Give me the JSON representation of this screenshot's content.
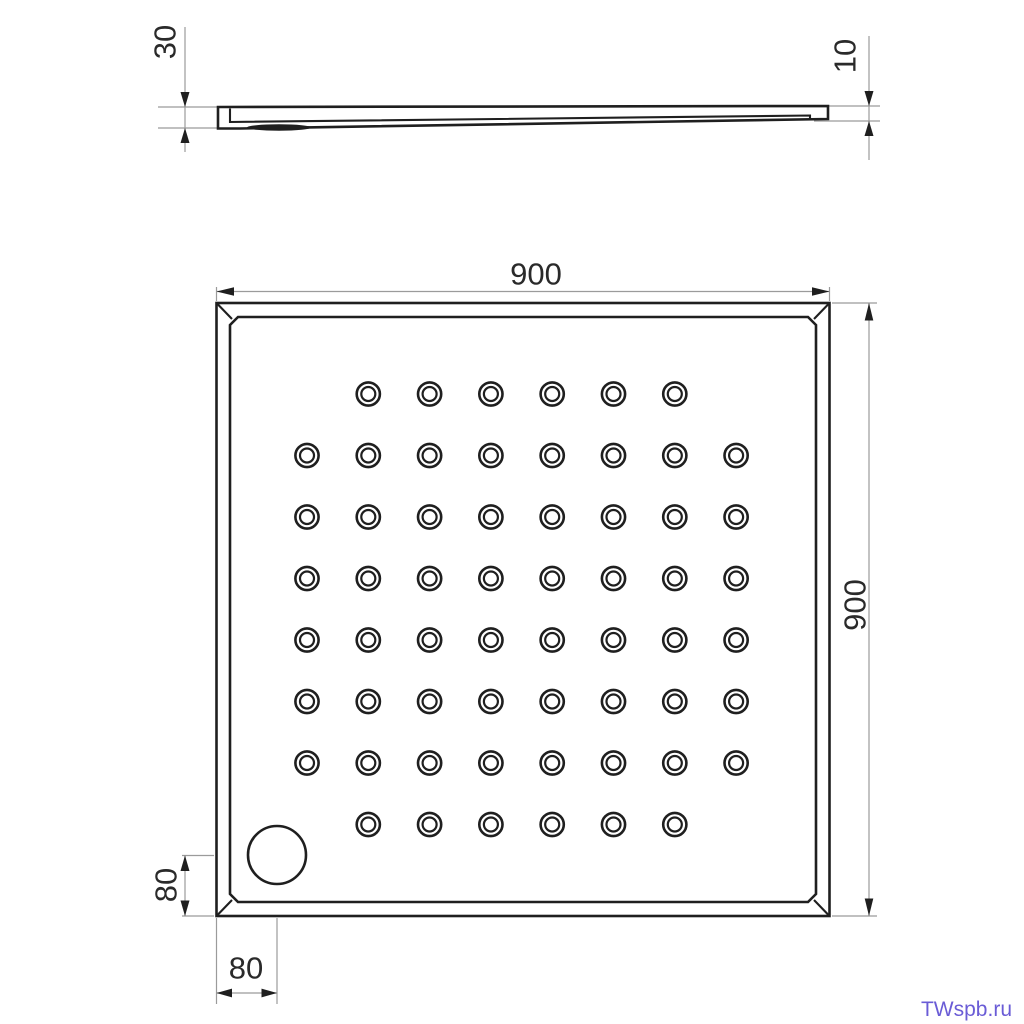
{
  "side_view": {
    "height_left_label": "30",
    "height_right_label": "10"
  },
  "top_view": {
    "width_label": "900",
    "depth_label": "900",
    "drain_offset_left_label": "80",
    "drain_offset_bottom_label": "80",
    "anti_slip_pattern": {
      "hole_rows": [
        6,
        8,
        8,
        8,
        8,
        8,
        8,
        6
      ],
      "total_holes": 56
    }
  },
  "watermark": {
    "text": "TWspb.ru",
    "color": "#6a5cd6"
  },
  "colors": {
    "background": "#ffffff",
    "line": "#1f1f1f",
    "dimension_line": "#9b9b9b",
    "dimension_text": "#2a2a2a"
  }
}
